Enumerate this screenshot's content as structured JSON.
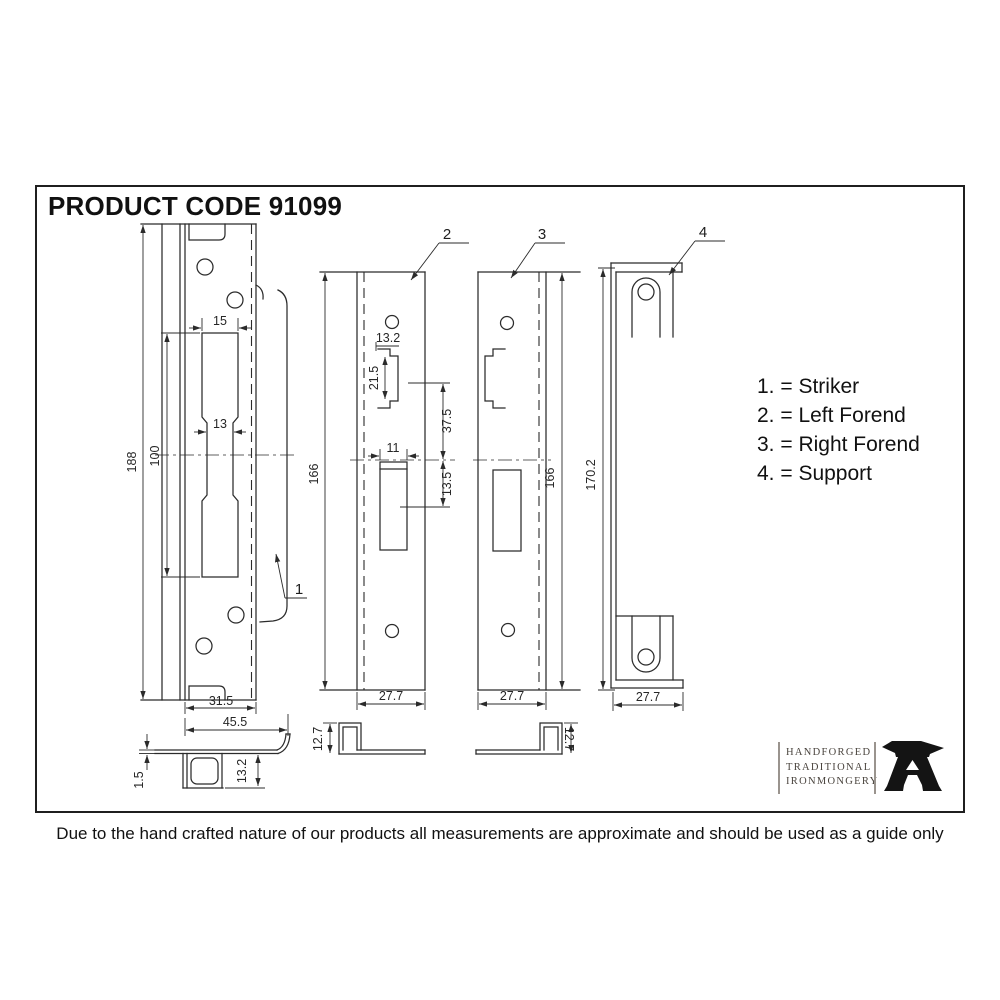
{
  "title": "PRODUCT CODE 91099",
  "disclaimer": "Due to the hand crafted nature of our products all measurements are approximate and should be used as a guide only",
  "legend": {
    "items": [
      "1. = Striker",
      "2. = Left Forend",
      "3. = Right Forend",
      "4. = Support"
    ]
  },
  "logo": {
    "line1": "HANDFORGED",
    "line2": "TRADITIONAL",
    "line3": "IRONMONGERY",
    "icon": "anvil-icon"
  },
  "parts": {
    "striker": {
      "callout": "1",
      "name": "Striker",
      "dims": {
        "height": "188",
        "slot_height": "100",
        "slot_top_width": "15",
        "slot_width": "13",
        "fold_width": "31.5",
        "total_width": "45.5",
        "thickness": "1.5",
        "lip_depth": "13.2"
      }
    },
    "left_forend": {
      "callout": "2",
      "name": "Left Forend",
      "dims": {
        "height": "166",
        "latch_width": "13.2",
        "latch_height": "21.5",
        "latch_to_centre": "37.5",
        "slot_width": "11",
        "centre_to_slot": "13.5",
        "width": "27.7",
        "return_depth": "12.7"
      }
    },
    "right_forend": {
      "callout": "3",
      "name": "Right Forend",
      "dims": {
        "height": "166",
        "width": "27.7",
        "return_depth": "12.7"
      }
    },
    "support": {
      "callout": "4",
      "name": "Support",
      "dims": {
        "height": "170.2",
        "width": "27.7"
      }
    }
  },
  "colors": {
    "line": "#2b2b2b",
    "dim_text": "#262626",
    "logo_text": "#4a443e",
    "anvil": "#141414"
  }
}
